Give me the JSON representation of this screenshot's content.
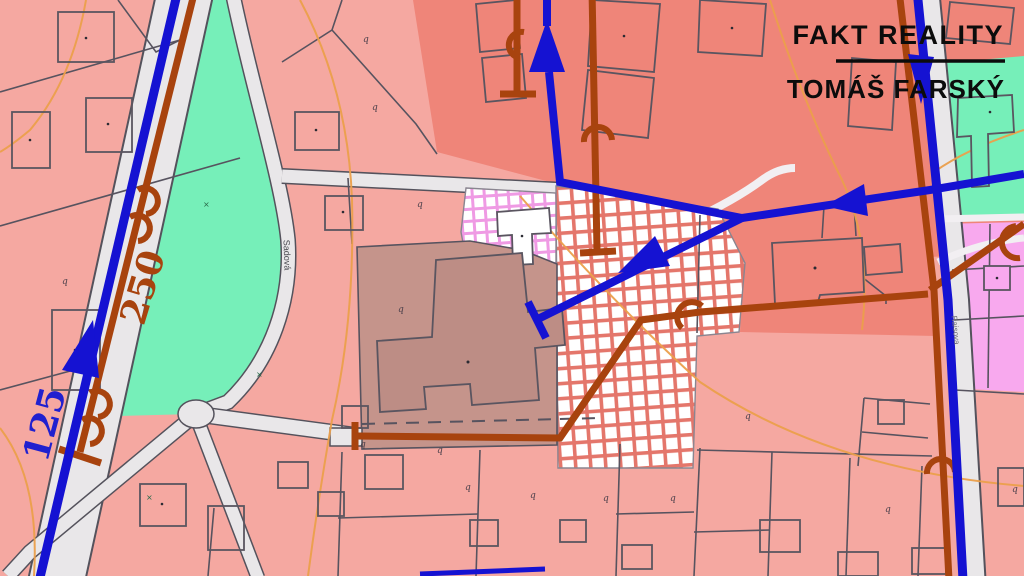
{
  "branding": {
    "agency": "FAKT REALITY",
    "agent": "TOMÁŠ FARSKÝ"
  },
  "map_labels": {
    "pipe_measure_250": "250",
    "pipe_measure_125": "125",
    "street_left": "Sadová",
    "street_right": "Raisova"
  },
  "symbols": {
    "parcel_glyph": "q",
    "meadow_glyph": "×"
  },
  "colors": {
    "parcel_pink": "#f5a8a1",
    "zone_salmon": "#ef8579",
    "greenery": "#76efb9",
    "garden_magenta": "#f8a9ee",
    "highlight_mauve": "#c5948b",
    "highlight_mauve_dark": "#bd8d85",
    "road_gray": "#e9e7e9",
    "water_line_blue": "#1512d2",
    "utility_line_brown": "#a8430e",
    "contour_orange": "#eb9f4b",
    "hatch_red": "#e4766b",
    "hatch_magenta": "#ef9ae4"
  }
}
